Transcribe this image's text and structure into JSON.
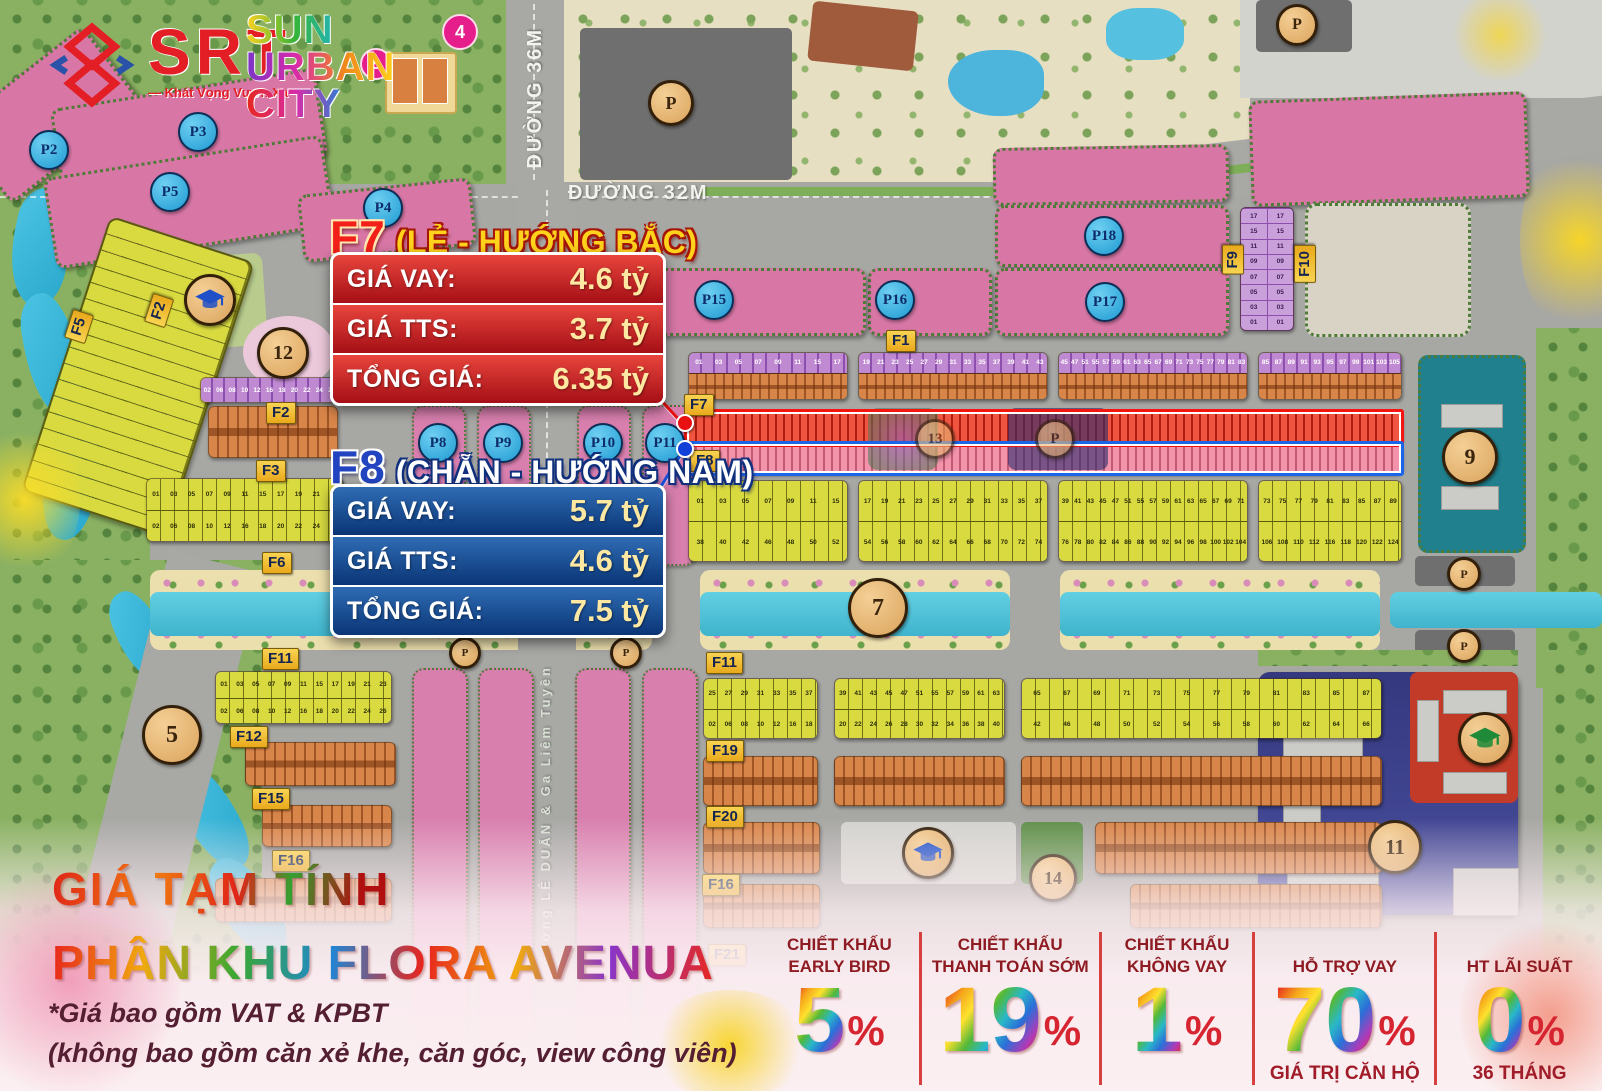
{
  "brand": {
    "srt_text": "SRT",
    "srt_tagline": "— Khát Vọng Vươn Xa —",
    "sun_line1": "SUN",
    "sun_line2": "URBAN",
    "sun_line3": "CITY"
  },
  "roads": {
    "duong_36m": "ĐƯỜNG 36M",
    "duong_32m": "ĐƯỜNG 32M",
    "le_duan": "đường LÊ DUẨN & Ga Liêm Tuyền"
  },
  "info_boxes": {
    "f7": {
      "block": "F7",
      "subtitle": "(LẺ - HƯỚNG BẮC)",
      "rows": [
        {
          "label": "GIÁ VAY:",
          "value": "4.6 tỷ"
        },
        {
          "label": "GIÁ TTS:",
          "value": "3.7 tỷ"
        },
        {
          "label": "TỔNG GIÁ:",
          "value": "6.35 tỷ"
        }
      ]
    },
    "f8": {
      "block": "F8",
      "subtitle": "(CHẴN - HƯỚNG NAM)",
      "rows": [
        {
          "label": "GIÁ VAY:",
          "value": "5.7 tỷ"
        },
        {
          "label": "GIÁ TTS:",
          "value": "4.6 tỷ"
        },
        {
          "label": "TỔNG GIÁ:",
          "value": "7.5 tỷ"
        }
      ]
    }
  },
  "footer": {
    "title1": "GIÁ TẠM TÍNH",
    "title2": "PHÂN KHU FLORA AVENUA",
    "note1": "*Giá bao gồm VAT & KPBT",
    "note2": "(không bao gồm căn xẻ khe, căn góc, view công viên)"
  },
  "discounts": [
    {
      "label1": "CHIẾT KHẤU",
      "label2": "EARLY BIRD",
      "value": "5",
      "unit": "%",
      "sub": ""
    },
    {
      "label1": "CHIẾT KHẤU",
      "label2": "THANH TOÁN SỚM",
      "value": "19",
      "unit": "%",
      "sub": ""
    },
    {
      "label1": "CHIẾT KHẤU",
      "label2": "KHÔNG VAY",
      "value": "1",
      "unit": "%",
      "sub": ""
    },
    {
      "label1": "HỖ TRỢ VAY",
      "label2": "",
      "value": "70",
      "unit": "%",
      "sub": "GIÁ TRỊ CĂN HỘ"
    },
    {
      "label1": "HT LÃI SUẤT",
      "label2": "",
      "value": "0",
      "unit": "%",
      "sub": "36 THÁNG"
    }
  ],
  "colors": {
    "red_box": "#b01220",
    "blue_box": "#0a3576",
    "f_label_yellow": "#f0c030",
    "pink_block": "#d877a6",
    "purple_lot": "#8d4fae",
    "yellow_lot": "#d8da40",
    "orange_lot": "#c06a32",
    "canal": "#4fc0d8",
    "teal_block": "#20808e",
    "navy_block": "#3b3f90",
    "accent_red": "#e8251d",
    "accent_blue": "#1b66e8"
  },
  "map": {
    "p_circles": [
      {
        "label": "P2",
        "x": 47,
        "y": 148
      },
      {
        "label": "P3",
        "x": 196,
        "y": 130
      },
      {
        "label": "P5",
        "x": 168,
        "y": 190
      },
      {
        "label": "P4",
        "x": 381,
        "y": 206
      },
      {
        "label": "P15",
        "x": 712,
        "y": 298
      },
      {
        "label": "P16",
        "x": 893,
        "y": 298
      },
      {
        "label": "P17",
        "x": 1103,
        "y": 300
      },
      {
        "label": "P18",
        "x": 1102,
        "y": 234
      },
      {
        "label": "P8",
        "x": 436,
        "y": 441
      },
      {
        "label": "P9",
        "x": 501,
        "y": 441
      },
      {
        "label": "P10",
        "x": 601,
        "y": 441
      },
      {
        "label": "P11",
        "x": 663,
        "y": 441
      }
    ],
    "f_labels": [
      {
        "label": "F1",
        "x": 886,
        "y": 330
      },
      {
        "label": "F7",
        "x": 684,
        "y": 394
      },
      {
        "label": "F8",
        "x": 690,
        "y": 450
      },
      {
        "label": "F5",
        "x": 68,
        "y": 312,
        "vert": true,
        "rot": 18
      },
      {
        "label": "F2",
        "x": 148,
        "y": 296,
        "vert": true,
        "rot": 18
      },
      {
        "label": "F2",
        "x": 266,
        "y": 402
      },
      {
        "label": "F3",
        "x": 256,
        "y": 460
      },
      {
        "label": "F6",
        "x": 262,
        "y": 552
      },
      {
        "label": "F9",
        "x": 1222,
        "y": 245,
        "vert": true
      },
      {
        "label": "F10",
        "x": 1294,
        "y": 245,
        "vert": true
      },
      {
        "label": "F11",
        "x": 262,
        "y": 648
      },
      {
        "label": "F11",
        "x": 706,
        "y": 652
      },
      {
        "label": "F12",
        "x": 230,
        "y": 726
      },
      {
        "label": "F19",
        "x": 706,
        "y": 740
      },
      {
        "label": "F15",
        "x": 252,
        "y": 788
      },
      {
        "label": "F20",
        "x": 706,
        "y": 806
      },
      {
        "label": "F16",
        "x": 272,
        "y": 850
      },
      {
        "label": "F16",
        "x": 702,
        "y": 874
      },
      {
        "label": "F21",
        "x": 708,
        "y": 944
      }
    ],
    "tan_circles": [
      {
        "label": "7",
        "x": 875,
        "y": 605,
        "size": 54
      },
      {
        "label": "9",
        "x": 1467,
        "y": 454,
        "size": 50
      },
      {
        "label": "11",
        "x": 1392,
        "y": 844,
        "size": 48
      },
      {
        "label": "12",
        "x": 280,
        "y": 350,
        "size": 46
      },
      {
        "label": "14",
        "x": 1050,
        "y": 875,
        "size": 42
      },
      {
        "label": "5",
        "x": 169,
        "y": 732,
        "size": 54
      },
      {
        "label": "13",
        "x": 932,
        "y": 436,
        "size": 34,
        "faint": true
      },
      {
        "label": "P",
        "x": 1052,
        "y": 436,
        "size": 34,
        "faint": true
      },
      {
        "label": "P",
        "x": 668,
        "y": 100,
        "size": 40
      },
      {
        "label": "P",
        "x": 1294,
        "y": 22,
        "size": 36
      },
      {
        "label": "P",
        "x": 1461,
        "y": 571,
        "size": 28
      },
      {
        "label": "P",
        "x": 1461,
        "y": 643,
        "size": 28
      },
      {
        "label": "P",
        "x": 462,
        "y": 650,
        "size": 26
      },
      {
        "label": "P",
        "x": 623,
        "y": 650,
        "size": 26
      }
    ],
    "pink_circles": [
      {
        "label": "4",
        "x": 458,
        "y": 30,
        "size": 32
      },
      {
        "label": "5",
        "x": 374,
        "y": 62,
        "size": 28
      }
    ],
    "school_icons": [
      {
        "x": 207,
        "y": 297,
        "size": 46,
        "cap": "#2050c8"
      },
      {
        "x": 925,
        "y": 850,
        "size": 46,
        "cap": "#2050c8"
      },
      {
        "x": 1482,
        "y": 736,
        "size": 48,
        "cap": "#1f8a38"
      }
    ],
    "lot_strips": [
      {
        "type": "po",
        "x": 688,
        "y": 352,
        "w": 158,
        "h": 46,
        "top": "01 03 05 07 09 11 15 17"
      },
      {
        "type": "po",
        "x": 858,
        "y": 352,
        "w": 188,
        "h": 46,
        "top": "19 21 23 25 27 29 31 33 35 37 39 41 43"
      },
      {
        "type": "po",
        "x": 1058,
        "y": 352,
        "w": 188,
        "h": 46,
        "top": "45 47 51 55 57 59 61 63 65 67 69 71 73 75 77 79 81 83"
      },
      {
        "type": "po",
        "x": 1258,
        "y": 352,
        "w": 142,
        "h": 46,
        "top": "85 87 89 91 93 95 97 99 101 103 105"
      },
      {
        "type": "red",
        "x": 688,
        "y": 412,
        "w": 712,
        "h": 31
      },
      {
        "type": "pink",
        "x": 688,
        "y": 443,
        "w": 712,
        "h": 29
      },
      {
        "type": "yy",
        "x": 688,
        "y": 480,
        "w": 158,
        "h": 80,
        "top": "01 03 05 07 09 11 15",
        "bottom": "38 40 42 46 48 50 52"
      },
      {
        "type": "yy",
        "x": 858,
        "y": 480,
        "w": 188,
        "h": 80,
        "top": "17 19 21 23 25 27 29 31 33 35 37",
        "bottom": "54 56 58 60 62 64 66 68 70 72 74"
      },
      {
        "type": "yy",
        "x": 1058,
        "y": 480,
        "w": 188,
        "h": 80,
        "top": "39 41 43 45 47 51 55 57 59 61 63 65 67 69 71",
        "bottom": "76 78 80 82 84 86 88 90 92 94 96 98 100 102 104"
      },
      {
        "type": "yy",
        "x": 1258,
        "y": 480,
        "w": 142,
        "h": 80,
        "top": "73 75 77 79 81 83 85 87 89",
        "bottom": "106 108 110 112 116 118 120 122 124"
      },
      {
        "type": "pgrid",
        "x": 1240,
        "y": 207,
        "w": 52,
        "h": 122,
        "top": "17 15 11 09 07 05 03 01"
      },
      {
        "type": "purple",
        "x": 200,
        "y": 377,
        "w": 137,
        "h": 24,
        "top": "02 06 08 10 12 16 18 20 22 24 26"
      },
      {
        "type": "orange",
        "x": 208,
        "y": 406,
        "w": 128,
        "h": 50
      },
      {
        "type": "yy",
        "x": 146,
        "y": 478,
        "w": 196,
        "h": 62,
        "top": "01 03 05 07 09 11 15 17 19 21 23",
        "bottom": "02 06 08 10 12 16 18 20 22 24 26"
      },
      {
        "type": "yy",
        "x": 215,
        "y": 671,
        "w": 175,
        "h": 51,
        "top": "01 03 05 07 09 11 15 17 19 21 23",
        "bottom": "02 06 08 10 12 16 18 20 22 24 26"
      },
      {
        "type": "yy",
        "x": 703,
        "y": 678,
        "w": 113,
        "h": 59,
        "top": "25 27 29 31 33 35 37",
        "bottom": "02 06 08 10 12 16 18"
      },
      {
        "type": "yy",
        "x": 834,
        "y": 678,
        "w": 169,
        "h": 59,
        "top": "39 41 43 45 47 51 55 57 59 61 63",
        "bottom": "20 22 24 26 28 30 32 34 36 38 40"
      },
      {
        "type": "yy",
        "x": 1021,
        "y": 678,
        "w": 359,
        "h": 59,
        "top": "65 67 69 71 73 75 77 79 81 83 85 87",
        "bottom": "42 46 48 50 52 54 56 58 60 62 64 66"
      },
      {
        "type": "orange",
        "x": 245,
        "y": 742,
        "w": 149,
        "h": 42
      },
      {
        "type": "orange",
        "x": 262,
        "y": 805,
        "w": 128,
        "h": 40
      },
      {
        "type": "orange",
        "x": 703,
        "y": 756,
        "w": 113,
        "h": 48
      },
      {
        "type": "orange",
        "x": 834,
        "y": 756,
        "w": 169,
        "h": 48
      },
      {
        "type": "orange",
        "x": 1021,
        "y": 756,
        "w": 359,
        "h": 48
      },
      {
        "type": "orange",
        "x": 703,
        "y": 822,
        "w": 115,
        "h": 50
      },
      {
        "type": "orange",
        "x": 1095,
        "y": 822,
        "w": 285,
        "h": 50
      },
      {
        "type": "orange",
        "x": 703,
        "y": 884,
        "w": 115,
        "h": 42
      },
      {
        "type": "orange",
        "x": 1130,
        "y": 884,
        "w": 250,
        "h": 42
      },
      {
        "type": "orange",
        "x": 215,
        "y": 878,
        "w": 175,
        "h": 42
      }
    ]
  }
}
